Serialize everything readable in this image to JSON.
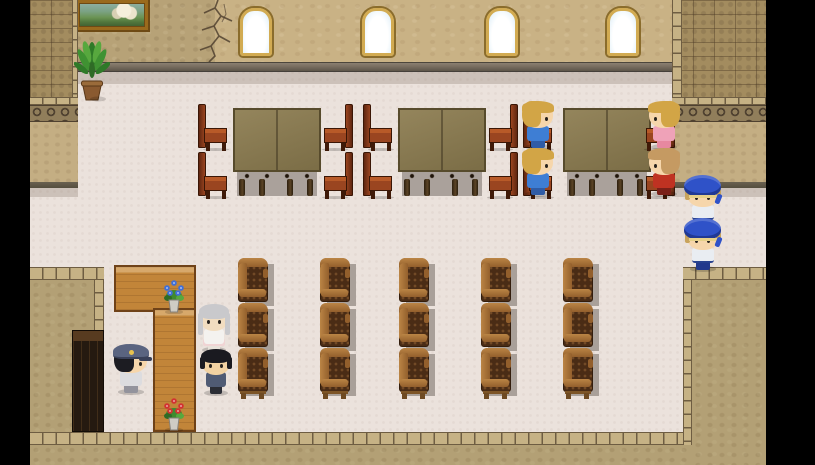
{
  "scene": {
    "width": 815,
    "height": 465,
    "background": "#000000",
    "type": "rpg-interior-map"
  },
  "colors": {
    "floorPink": "#ebe2dc",
    "floorShadow": "rgba(110,95,80,0.25)",
    "wallPlaster": "#b7a277",
    "wallWindow": "#c9b285",
    "ledgeTop": "#7d7264",
    "ledgeDark": "#5d5549",
    "brick": "#a38c5f",
    "brickLine": "rgba(80,62,40,0.45)",
    "brickEdgeLight": "#c6b285",
    "brickEdgeLine": "#6e5d42",
    "scrollBg": "#917e5b",
    "scrollDark": "#4f4130",
    "lowerTan": "#c4ae83",
    "wallEdgeDark": "#554e3e",
    "blockTan": "#b3a075",
    "windowFrame": "#d2ab52",
    "windowFrameDark": "#8a6c2c",
    "tableTopA": "#94855c",
    "tableTopB": "#7b6d46",
    "tableBorder": "#574b2c",
    "underShadow": "#aaa19b",
    "chairRed": "#9a4520",
    "chairRedDark": "#5f2610",
    "chairRedHi": "#b85a28",
    "chairLeg": "#3f1a08",
    "armTan": "#bb8545",
    "armTanDark": "#935f2c",
    "armBody": "#4a2c15",
    "armTuft": "rgba(175,120,65,0.40)",
    "armLegs": "#6e4a22",
    "shadowGray": "#a9a099",
    "counterWood": "#c28539",
    "counterDark": "#6f4218",
    "cabinetBody": "#251a10",
    "cabinetTop": "#573b20",
    "cabinetLine": "rgba(130,90,45,0.30)",
    "crack": "#4a3b2b",
    "potBrown": "#8a5a30",
    "vasePot": "#cfccc4",
    "flowerBlue": "#3f6fd8",
    "flowerRed": "#d23232"
  },
  "elements": [
    {
      "type": "rect",
      "name": "room-floor",
      "cls": "floorPink",
      "x": 30,
      "y": 62,
      "w": 736,
      "h": 370
    },
    {
      "type": "shadow",
      "name": "wall-shadow-strip",
      "x": 72,
      "y": 72,
      "w": 600,
      "h": 12
    },
    {
      "type": "rect",
      "name": "wall-plaster-section",
      "cls": "wallPlaster",
      "x": 72,
      "y": 0,
      "w": 143,
      "h": 62
    },
    {
      "type": "rect",
      "name": "wall-window-section",
      "cls": "wallWindow",
      "x": 215,
      "y": 0,
      "w": 457,
      "h": 62
    },
    {
      "type": "rect",
      "name": "wall-ledge",
      "cls": "ledge",
      "x": 72,
      "y": 62,
      "w": 600,
      "h": 10
    },
    {
      "type": "crack",
      "name": "wall-crack-decal",
      "x": 188,
      "y": 0,
      "w": 52,
      "h": 62
    },
    {
      "type": "painting",
      "name": "castle-painting",
      "x": 76,
      "y": 0,
      "w": 72,
      "h": 30
    },
    {
      "type": "window",
      "name": "arched-window-1",
      "x": 240,
      "y": 8,
      "w": 32,
      "h": 48
    },
    {
      "type": "window",
      "name": "arched-window-2",
      "x": 362,
      "y": 8,
      "w": 32,
      "h": 48
    },
    {
      "type": "window",
      "name": "arched-window-3",
      "x": 486,
      "y": 8,
      "w": 32,
      "h": 48
    },
    {
      "type": "window",
      "name": "arched-window-4",
      "x": 607,
      "y": 8,
      "w": 32,
      "h": 48
    },
    {
      "type": "column",
      "name": "left-wall-column",
      "x": 30,
      "y": 0,
      "w": 48,
      "h": 188,
      "props": {
        "side": "left"
      }
    },
    {
      "type": "column",
      "name": "right-wall-column",
      "x": 672,
      "y": 0,
      "w": 94,
      "h": 188,
      "props": {
        "side": "right"
      }
    },
    {
      "type": "shadow",
      "name": "left-column-shadow",
      "x": 30,
      "y": 188,
      "w": 48,
      "h": 9
    },
    {
      "type": "shadow",
      "name": "right-column-shadow",
      "x": 672,
      "y": 188,
      "w": 94,
      "h": 9
    },
    {
      "type": "rect",
      "name": "bottom-left-block-top-edge",
      "cls": "brickEdgeH",
      "x": 30,
      "y": 267,
      "w": 74,
      "h": 13
    },
    {
      "type": "rect",
      "name": "bottom-left-block-fill",
      "cls": "blockTan",
      "x": 30,
      "y": 280,
      "w": 64,
      "h": 185
    },
    {
      "type": "rect",
      "name": "bottom-left-block-right-edge",
      "cls": "brickEdgeV",
      "x": 94,
      "y": 280,
      "w": 10,
      "h": 152
    },
    {
      "type": "rect",
      "name": "bottom-right-block-top-edge",
      "cls": "brickEdgeH",
      "x": 683,
      "y": 267,
      "w": 83,
      "h": 13
    },
    {
      "type": "rect",
      "name": "bottom-right-block-fill",
      "cls": "blockTan",
      "x": 692,
      "y": 280,
      "w": 74,
      "h": 185
    },
    {
      "type": "rect",
      "name": "bottom-right-block-left-edge",
      "cls": "brickEdgeV",
      "x": 683,
      "y": 280,
      "w": 9,
      "h": 165
    },
    {
      "type": "rect",
      "name": "bottom-wall-edge",
      "cls": "brickEdgeH",
      "x": 30,
      "y": 432,
      "w": 653,
      "h": 13
    },
    {
      "type": "rect",
      "name": "bottom-wall-fill",
      "cls": "blockTan",
      "x": 30,
      "y": 445,
      "w": 662,
      "h": 20
    },
    {
      "type": "rect",
      "name": "reception-counter-top",
      "cls": "counter",
      "x": 114,
      "y": 265,
      "w": 82,
      "h": 47
    },
    {
      "type": "rect",
      "name": "reception-counter-side",
      "cls": "counter",
      "x": 153,
      "y": 308,
      "w": 43,
      "h": 124
    },
    {
      "type": "rect",
      "name": "dark-cabinet",
      "cls": "cabinet",
      "x": 72,
      "y": 330,
      "w": 32,
      "h": 102
    },
    {
      "type": "plant",
      "name": "potted-plant",
      "x": 74,
      "y": 36,
      "w": 36,
      "h": 66
    },
    {
      "type": "table",
      "name": "dining-table-1",
      "x": 233,
      "y": 108,
      "w": 88,
      "h": 88
    },
    {
      "type": "table",
      "name": "dining-table-2",
      "x": 398,
      "y": 108,
      "w": 88,
      "h": 88
    },
    {
      "type": "table",
      "name": "dining-table-3",
      "x": 563,
      "y": 108,
      "w": 88,
      "h": 88
    },
    {
      "type": "side-chair",
      "name": "chair-t1-left-top",
      "x": 198,
      "y": 104,
      "w": 30,
      "h": 47,
      "props": {
        "flip": false
      }
    },
    {
      "type": "side-chair",
      "name": "chair-t1-left-bottom",
      "x": 198,
      "y": 152,
      "w": 30,
      "h": 47,
      "props": {
        "flip": false
      }
    },
    {
      "type": "side-chair",
      "name": "chair-t1-right-top",
      "x": 323,
      "y": 104,
      "w": 30,
      "h": 47,
      "props": {
        "flip": true
      }
    },
    {
      "type": "side-chair",
      "name": "chair-t1-right-bottom",
      "x": 323,
      "y": 152,
      "w": 30,
      "h": 47,
      "props": {
        "flip": true
      }
    },
    {
      "type": "side-chair",
      "name": "chair-t2-left-top",
      "x": 363,
      "y": 104,
      "w": 30,
      "h": 47,
      "props": {
        "flip": false
      }
    },
    {
      "type": "side-chair",
      "name": "chair-t2-left-bottom",
      "x": 363,
      "y": 152,
      "w": 30,
      "h": 47,
      "props": {
        "flip": false
      }
    },
    {
      "type": "side-chair",
      "name": "chair-t2-right-top",
      "x": 488,
      "y": 104,
      "w": 30,
      "h": 47,
      "props": {
        "flip": true
      }
    },
    {
      "type": "side-chair",
      "name": "chair-t2-right-bottom",
      "x": 488,
      "y": 152,
      "w": 30,
      "h": 47,
      "props": {
        "flip": true
      }
    },
    {
      "type": "side-chair",
      "name": "chair-t3-left-top",
      "x": 523,
      "y": 104,
      "w": 30,
      "h": 47,
      "props": {
        "flip": false
      }
    },
    {
      "type": "side-chair",
      "name": "chair-t3-left-bottom",
      "x": 523,
      "y": 152,
      "w": 30,
      "h": 47,
      "props": {
        "flip": false
      }
    },
    {
      "type": "side-chair",
      "name": "chair-t3-right-top",
      "x": 645,
      "y": 104,
      "w": 30,
      "h": 47,
      "props": {
        "flip": true
      }
    },
    {
      "type": "side-chair",
      "name": "chair-t3-right-bottom",
      "x": 645,
      "y": 152,
      "w": 30,
      "h": 47,
      "props": {
        "flip": true
      }
    },
    {
      "type": "armchair",
      "name": "armchair-c1-r1",
      "x": 238,
      "y": 258,
      "w": 37,
      "h": 47,
      "props": {
        "legs": false
      }
    },
    {
      "type": "armchair",
      "name": "armchair-c1-r2",
      "x": 238,
      "y": 303,
      "w": 37,
      "h": 47,
      "props": {
        "legs": false
      }
    },
    {
      "type": "armchair",
      "name": "armchair-c1-r3",
      "x": 238,
      "y": 348,
      "w": 37,
      "h": 52,
      "props": {
        "legs": true
      }
    },
    {
      "type": "armchair",
      "name": "armchair-c2-r1",
      "x": 320,
      "y": 258,
      "w": 37,
      "h": 47,
      "props": {
        "legs": false
      }
    },
    {
      "type": "armchair",
      "name": "armchair-c2-r2",
      "x": 320,
      "y": 303,
      "w": 37,
      "h": 47,
      "props": {
        "legs": false
      }
    },
    {
      "type": "armchair",
      "name": "armchair-c2-r3",
      "x": 320,
      "y": 348,
      "w": 37,
      "h": 52,
      "props": {
        "legs": true
      }
    },
    {
      "type": "armchair",
      "name": "armchair-c3-r1",
      "x": 399,
      "y": 258,
      "w": 37,
      "h": 47,
      "props": {
        "legs": false
      }
    },
    {
      "type": "armchair",
      "name": "armchair-c3-r2",
      "x": 399,
      "y": 303,
      "w": 37,
      "h": 47,
      "props": {
        "legs": false
      }
    },
    {
      "type": "armchair",
      "name": "armchair-c3-r3",
      "x": 399,
      "y": 348,
      "w": 37,
      "h": 52,
      "props": {
        "legs": true
      }
    },
    {
      "type": "armchair",
      "name": "armchair-c4-r1",
      "x": 481,
      "y": 258,
      "w": 37,
      "h": 47,
      "props": {
        "legs": false
      }
    },
    {
      "type": "armchair",
      "name": "armchair-c4-r2",
      "x": 481,
      "y": 303,
      "w": 37,
      "h": 47,
      "props": {
        "legs": false
      }
    },
    {
      "type": "armchair",
      "name": "armchair-c4-r3",
      "x": 481,
      "y": 348,
      "w": 37,
      "h": 52,
      "props": {
        "legs": true
      }
    },
    {
      "type": "armchair",
      "name": "armchair-c5-r1",
      "x": 563,
      "y": 258,
      "w": 37,
      "h": 47,
      "props": {
        "legs": false
      }
    },
    {
      "type": "armchair",
      "name": "armchair-c5-r2",
      "x": 563,
      "y": 303,
      "w": 37,
      "h": 47,
      "props": {
        "legs": false
      }
    },
    {
      "type": "armchair",
      "name": "armchair-c5-r3",
      "x": 563,
      "y": 348,
      "w": 37,
      "h": 52,
      "props": {
        "legs": true
      }
    },
    {
      "type": "vase",
      "name": "blue-flower-vase",
      "x": 158,
      "y": 262,
      "w": 32,
      "h": 52,
      "props": {
        "flower": "#3f6fd8"
      }
    },
    {
      "type": "vase",
      "name": "red-flower-vase",
      "x": 158,
      "y": 390,
      "w": 32,
      "h": 42,
      "props": {
        "flower": "#d23232"
      }
    },
    {
      "type": "character",
      "name": "npc-seated-boy-blue-top",
      "x": 520,
      "y": 102,
      "w": 36,
      "h": 48,
      "props": {
        "facing": "right",
        "palette": {
          "hair": "#d2a546",
          "skin": "#f6d6ab",
          "torso": "#3e7ed4",
          "legs": "#2f5ca6"
        }
      }
    },
    {
      "type": "character",
      "name": "npc-seated-boy-blue-bottom",
      "x": 520,
      "y": 149,
      "w": 36,
      "h": 48,
      "props": {
        "facing": "right",
        "palette": {
          "hair": "#d2a546",
          "skin": "#f6d6ab",
          "torso": "#3e7ed4",
          "legs": "#2f5ca6"
        }
      }
    },
    {
      "type": "character",
      "name": "npc-seated-girl-pink",
      "x": 646,
      "y": 102,
      "w": 36,
      "h": 48,
      "props": {
        "facing": "left",
        "palette": {
          "hair": "#d2a546",
          "skin": "#f6d6ab",
          "torso": "#efa2b8",
          "legs": "#e788a0"
        }
      }
    },
    {
      "type": "character",
      "name": "npc-seated-man-red",
      "x": 646,
      "y": 149,
      "w": 36,
      "h": 48,
      "props": {
        "facing": "left",
        "palette": {
          "hair": "#c59a62",
          "skin": "#f6d6ab",
          "torso": "#bf3222",
          "legs": "#7a2018"
        }
      }
    },
    {
      "type": "character",
      "name": "npc-guard-beret-top",
      "x": 684,
      "y": 181,
      "w": 38,
      "h": 48,
      "props": {
        "facing": "down",
        "hat": "beret",
        "palette": {
          "hat": "#2f52c8",
          "hair": "#c8a35c",
          "skin": "#f6d6ab",
          "torso": "#e9edf2",
          "trim": "#27418e",
          "legs": "#22398c"
        }
      }
    },
    {
      "type": "character",
      "name": "npc-guard-beret-bottom",
      "x": 684,
      "y": 224,
      "w": 38,
      "h": 48,
      "props": {
        "facing": "down",
        "hat": "beret",
        "palette": {
          "hat": "#2f52c8",
          "hair": "#c8a35c",
          "skin": "#f6d6ab",
          "torso": "#e9edf2",
          "trim": "#27418e",
          "legs": "#22398c"
        }
      }
    },
    {
      "type": "character",
      "name": "npc-officer-cap",
      "x": 112,
      "y": 347,
      "w": 38,
      "h": 48,
      "props": {
        "facing": "right",
        "hat": "cap",
        "palette": {
          "hat": "#5a6480",
          "hatDark": "#394058",
          "badge": "#e8c24e",
          "hair": "#1c1c22",
          "skin": "#f6d6ab",
          "torso": "#dcdcdf",
          "legs": "#93939c"
        }
      }
    },
    {
      "type": "character",
      "name": "npc-elder-woman",
      "x": 197,
      "y": 305,
      "w": 34,
      "h": 48,
      "props": {
        "facing": "down",
        "longHair": true,
        "palette": {
          "hair": "#c9c9cc",
          "skin": "#f2ddc0",
          "torso": "#f4f2ef",
          "skirt": "#f0d4d4",
          "legs": "#e8e2da"
        }
      }
    },
    {
      "type": "character",
      "name": "npc-clerk-black-hair",
      "x": 199,
      "y": 350,
      "w": 34,
      "h": 46,
      "props": {
        "facing": "down",
        "palette": {
          "hair": "#1a1a20",
          "skin": "#f2d2a2",
          "torso": "#505b74",
          "legs": "#2b2d35"
        }
      }
    }
  ]
}
